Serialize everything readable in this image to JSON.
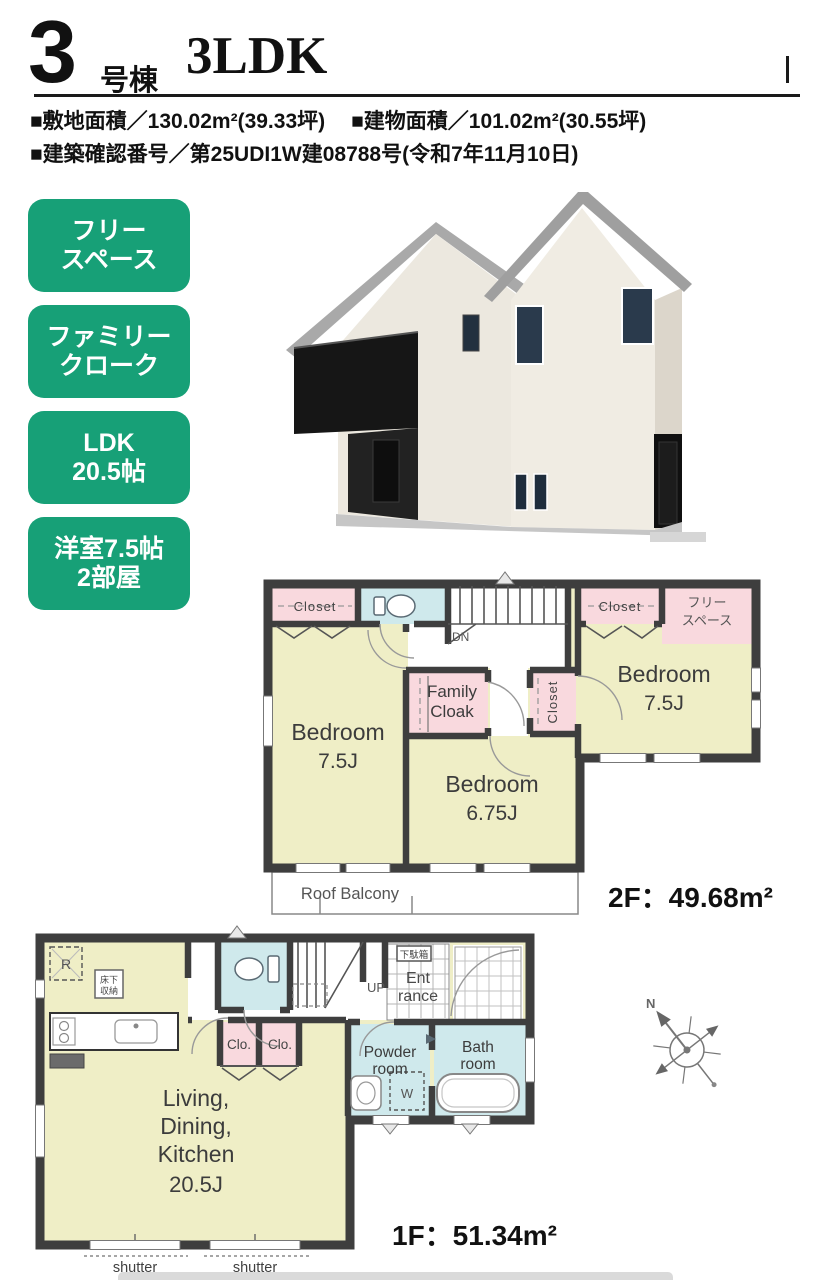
{
  "colors": {
    "accent_green": "#17a077",
    "room_yellow": "#efeec6",
    "closet_pink": "#f9d9de",
    "water_blue": "#cfe9ec",
    "wall": "#3e3e3e"
  },
  "header": {
    "unit_no": "3",
    "unit_suffix": "号棟",
    "layout": "3LDK"
  },
  "property": {
    "site_area": "■敷地面積／130.02m²(39.33坪)",
    "building_area": "■建物面積／101.02m²(30.55坪)",
    "permit": "■建築確認番号／第25UDI1W建08788号(令和7年11月10日)"
  },
  "badges": [
    {
      "line1": "フリー",
      "line2": "スペース"
    },
    {
      "line1": "ファミリー",
      "line2": "クローク"
    },
    {
      "line1": "LDK",
      "line2": "20.5帖"
    },
    {
      "line1": "洋室7.5帖",
      "line2": "2部屋"
    }
  ],
  "floor2": {
    "closet_left": "Closet",
    "closet_right": "Closet",
    "closet_mid": "Closet",
    "free_space_line1": "フリー",
    "free_space_line2": "スペース",
    "stairs_label": "DN",
    "bedroom_left_name": "Bedroom",
    "bedroom_left_size": "7.5J",
    "family_cloak_line1": "Family",
    "family_cloak_line2": "Cloak",
    "bedroom_center_name": "Bedroom",
    "bedroom_center_size": "6.75J",
    "bedroom_right_name": "Bedroom",
    "bedroom_right_size": "7.5J",
    "roof_balcony": "Roof Balcony",
    "area_label": "2F：49.68m²"
  },
  "floor1": {
    "ldk_line1": "Living,",
    "ldk_line2": "Dining,",
    "ldk_line3": "Kitchen",
    "ldk_line4": "20.5J",
    "stairs_label": "UP",
    "shoe_box": "下駄箱",
    "entrance_line1": "Ent",
    "entrance_line2": "rance",
    "closet1": "Clo.",
    "closet2": "Clo.",
    "powder_line1": "Powder",
    "powder_line2": "room",
    "bath_line1": "Bath",
    "bath_line2": "room",
    "washer": "W",
    "fridge": "R",
    "floor_storage_line1": "床下",
    "floor_storage_line2": "収納",
    "shutter1": "shutter",
    "shutter2": "shutter",
    "area_label": "1F：51.34m²"
  },
  "compass": {
    "north": "N"
  }
}
